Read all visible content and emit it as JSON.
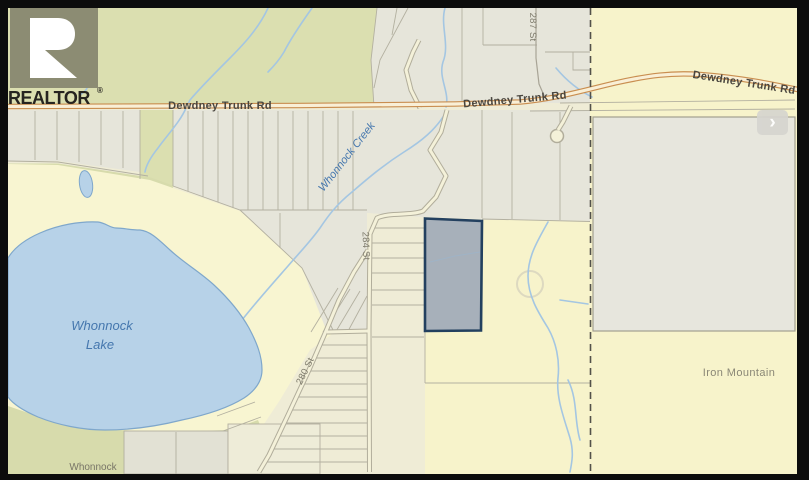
{
  "brand": {
    "logo_letter": "R",
    "name": "REALTOR",
    "registered": "®"
  },
  "map": {
    "roads": {
      "dewdney_trunk_rd": "Dewdney Trunk Rd",
      "street_287": "287 St",
      "street_284": "284 St",
      "street_280": "280 St"
    },
    "water": {
      "creek": "Whonnock Creek",
      "lake_line1": "Whonnock",
      "lake_line2": "Lake"
    },
    "places": {
      "iron_mountain": "Iron Mountain",
      "centre_line1": "Whonnock",
      "centre_line2": "Lake Centre"
    },
    "highlighted_parcel": {
      "status": "subject-property"
    }
  },
  "controls": {
    "next_icon": "›"
  },
  "colors": {
    "frame_black": "#0c0c0c",
    "olive_green": "#dbdfb0",
    "gray_parcel": "#e6e5da",
    "cream": "#efecd6",
    "bright_yellow": "#f7f3cb",
    "lake_blue": "#b7d2e8",
    "creek_blue": "#a4c6e2",
    "road_orange_casing": "#c98e50",
    "road_fill": "#f9efd6",
    "highlight_fill": "#a7b0ba",
    "highlight_border": "#23405f",
    "logo_block": "#8c8c73"
  }
}
